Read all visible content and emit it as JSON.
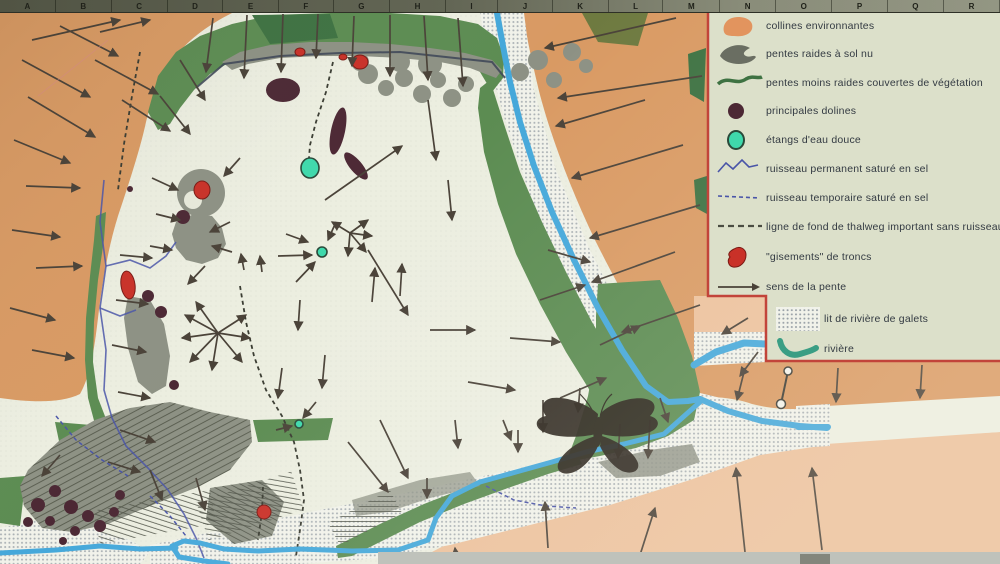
{
  "palette": {
    "hill_orange": "#d99a63",
    "salmon": "#ecc19c",
    "floor_cream": "#eceee0",
    "legend_bg": "#dce0ca",
    "veg_green": "#5c8c52",
    "dark_green": "#3e7242",
    "bare_gray": "#8d9184",
    "hatch_gray": "#565a4c",
    "river_blue": "#45a8da",
    "salt_blue": "#4a55a8",
    "pond_teal": "#3fd9ac",
    "doline_maroon": "#4c2834",
    "tronc_red": "#c93128",
    "arrow": "#4a4238",
    "legend_border": "#c2443a",
    "ruler_bg": "#6b6e5c",
    "text": "#333a42"
  },
  "ruler": {
    "letters": [
      "A",
      "B",
      "C",
      "D",
      "E",
      "F",
      "G",
      "H",
      "I",
      "J",
      "K",
      "L",
      "M",
      "N",
      "O",
      "P",
      "Q",
      "R"
    ]
  },
  "legend": {
    "items": [
      {
        "symbol": "hills",
        "label": "collines environnantes",
        "y": 3,
        "indent": 8
      },
      {
        "symbol": "steep",
        "label": "pentes raides à sol nu",
        "y": 31,
        "indent": 8
      },
      {
        "symbol": "gentle",
        "label": "pentes moins raides couvertes de végétation",
        "y": 60,
        "indent": 8
      },
      {
        "symbol": "doline",
        "label": "principales dolines",
        "y": 88,
        "indent": 8
      },
      {
        "symbol": "pond",
        "label": "étangs d'eau douce",
        "y": 117,
        "indent": 8
      },
      {
        "symbol": "perm",
        "label": "ruisseau permanent saturé en sel",
        "y": 146,
        "indent": 8
      },
      {
        "symbol": "temp",
        "label": "ruisseau temporaire saturé en sel",
        "y": 175,
        "indent": 8
      },
      {
        "symbol": "thalweg",
        "label": "ligne de fond de thalweg important sans ruisseau",
        "y": 204,
        "indent": 8
      },
      {
        "symbol": "troncs",
        "label": "\"gisements\" de troncs",
        "y": 234,
        "indent": 8
      },
      {
        "symbol": "slope",
        "label": "sens de la pente",
        "y": 264,
        "indent": 8
      },
      {
        "symbol": "gravel",
        "label": "lit de rivière de galets",
        "y": 296,
        "indent": 66
      },
      {
        "symbol": "river",
        "label": "rivière",
        "y": 326,
        "indent": 66
      }
    ]
  },
  "map": {
    "arrows": [
      [
        32,
        40,
        120,
        20
      ],
      [
        100,
        32,
        150,
        20
      ],
      [
        22,
        60,
        90,
        97
      ],
      [
        28,
        97,
        95,
        137
      ],
      [
        14,
        140,
        70,
        163
      ],
      [
        26,
        186,
        80,
        188
      ],
      [
        12,
        230,
        60,
        237
      ],
      [
        36,
        268,
        82,
        266
      ],
      [
        10,
        308,
        55,
        320
      ],
      [
        32,
        350,
        74,
        358
      ],
      [
        95,
        60,
        158,
        94
      ],
      [
        122,
        100,
        170,
        131
      ],
      [
        60,
        26,
        118,
        56
      ],
      [
        213,
        18,
        206,
        72
      ],
      [
        247,
        15,
        244,
        78
      ],
      [
        283,
        14,
        281,
        72
      ],
      [
        318,
        14,
        316,
        58
      ],
      [
        354,
        16,
        352,
        66
      ],
      [
        390,
        15,
        390,
        76
      ],
      [
        424,
        16,
        428,
        80
      ],
      [
        458,
        18,
        463,
        86
      ],
      [
        180,
        60,
        205,
        100
      ],
      [
        160,
        96,
        190,
        134
      ],
      [
        676,
        18,
        545,
        48
      ],
      [
        702,
        76,
        558,
        98
      ],
      [
        645,
        100,
        556,
        126
      ],
      [
        683,
        145,
        572,
        178
      ],
      [
        700,
        205,
        590,
        238
      ],
      [
        675,
        252,
        592,
        282
      ],
      [
        700,
        305,
        622,
        332
      ],
      [
        748,
        318,
        722,
        334
      ],
      [
        758,
        352,
        740,
        376
      ],
      [
        152,
        178,
        178,
        190
      ],
      [
        156,
        214,
        180,
        220
      ],
      [
        240,
        158,
        224,
        176
      ],
      [
        150,
        246,
        172,
        250
      ],
      [
        230,
        222,
        210,
        232
      ],
      [
        232,
        252,
        212,
        246
      ],
      [
        205,
        266,
        188,
        284
      ],
      [
        120,
        255,
        152,
        258
      ],
      [
        116,
        300,
        148,
        304
      ],
      [
        112,
        345,
        146,
        352
      ],
      [
        118,
        392,
        150,
        398
      ],
      [
        218,
        333,
        185,
        315
      ],
      [
        218,
        333,
        182,
        338
      ],
      [
        218,
        333,
        190,
        362
      ],
      [
        218,
        333,
        212,
        370
      ],
      [
        218,
        333,
        242,
        362
      ],
      [
        218,
        333,
        250,
        338
      ],
      [
        218,
        333,
        246,
        315
      ],
      [
        218,
        333,
        196,
        302
      ],
      [
        350,
        233,
        368,
        220
      ],
      [
        350,
        233,
        372,
        236
      ],
      [
        350,
        233,
        366,
        252
      ],
      [
        350,
        233,
        348,
        256
      ],
      [
        350,
        233,
        332,
        222
      ],
      [
        286,
        234,
        308,
        242
      ],
      [
        278,
        256,
        312,
        255
      ],
      [
        296,
        282,
        315,
        262
      ],
      [
        336,
        222,
        328,
        240
      ],
      [
        244,
        270,
        241,
        254
      ],
      [
        262,
        272,
        260,
        256
      ],
      [
        325,
        200,
        402,
        146
      ],
      [
        368,
        250,
        408,
        315
      ],
      [
        372,
        302,
        375,
        268
      ],
      [
        400,
        296,
        402,
        264
      ],
      [
        300,
        300,
        298,
        330
      ],
      [
        325,
        355,
        322,
        388
      ],
      [
        282,
        368,
        278,
        398
      ],
      [
        316,
        402,
        303,
        418
      ],
      [
        276,
        430,
        292,
        426
      ],
      [
        428,
        100,
        436,
        160
      ],
      [
        448,
        180,
        452,
        220
      ],
      [
        430,
        330,
        475,
        330
      ],
      [
        510,
        338,
        560,
        342
      ],
      [
        468,
        382,
        515,
        390
      ],
      [
        540,
        300,
        585,
        285
      ],
      [
        560,
        398,
        606,
        378
      ],
      [
        600,
        345,
        640,
        326
      ],
      [
        548,
        250,
        590,
        262
      ],
      [
        348,
        442,
        388,
        492
      ],
      [
        380,
        420,
        408,
        478
      ],
      [
        455,
        420,
        458,
        448
      ],
      [
        503,
        420,
        511,
        440
      ],
      [
        518,
        430,
        518,
        452
      ],
      [
        427,
        478,
        427,
        498
      ],
      [
        543,
        400,
        543,
        432
      ],
      [
        620,
        424,
        618,
        458
      ],
      [
        650,
        420,
        648,
        458
      ],
      [
        580,
        388,
        578,
        412
      ],
      [
        660,
        398,
        668,
        422
      ],
      [
        548,
        548,
        545,
        502
      ],
      [
        457,
        564,
        455,
        548
      ],
      [
        640,
        555,
        655,
        508
      ],
      [
        745,
        552,
        736,
        468
      ],
      [
        822,
        550,
        812,
        468
      ],
      [
        745,
        368,
        737,
        400
      ],
      [
        838,
        368,
        836,
        402
      ],
      [
        922,
        365,
        920,
        398
      ],
      [
        120,
        430,
        155,
        442
      ],
      [
        108,
        462,
        140,
        472
      ],
      [
        150,
        470,
        162,
        500
      ],
      [
        196,
        478,
        205,
        510
      ],
      [
        60,
        455,
        42,
        476
      ]
    ],
    "dolines": [
      [
        283,
        90,
        17,
        12,
        0
      ],
      [
        338,
        131,
        7,
        24,
        12
      ],
      [
        356,
        166,
        6,
        17,
        -40
      ],
      [
        183,
        217,
        7,
        7,
        0
      ],
      [
        148,
        296,
        6,
        6,
        0
      ],
      [
        161,
        312,
        6,
        6,
        0
      ],
      [
        174,
        385,
        5,
        5,
        0
      ],
      [
        130,
        189,
        3,
        3,
        0
      ],
      [
        38,
        505,
        7,
        7,
        0
      ],
      [
        55,
        491,
        6,
        6,
        0
      ],
      [
        71,
        507,
        7,
        7,
        0
      ],
      [
        88,
        516,
        6,
        6,
        0
      ],
      [
        50,
        521,
        5,
        5,
        0
      ],
      [
        75,
        531,
        5,
        5,
        0
      ],
      [
        100,
        526,
        6,
        6,
        0
      ],
      [
        114,
        512,
        5,
        5,
        0
      ],
      [
        28,
        522,
        5,
        5,
        0
      ],
      [
        63,
        541,
        4,
        4,
        0
      ],
      [
        120,
        495,
        5,
        5,
        0
      ]
    ],
    "ponds": [
      [
        310,
        168,
        9,
        10
      ],
      [
        322,
        252,
        5,
        5
      ],
      [
        299,
        424,
        4,
        4
      ]
    ],
    "troncs": [
      [
        360,
        62,
        8,
        7,
        0
      ],
      [
        300,
        52,
        5,
        4,
        0
      ],
      [
        343,
        57,
        4,
        3,
        0
      ],
      [
        202,
        190,
        8,
        9,
        0
      ],
      [
        128,
        285,
        7,
        14,
        -8
      ],
      [
        264,
        512,
        7,
        7,
        0
      ]
    ],
    "salt_streams": [
      [
        [
          104,
          180
        ],
        [
          100,
          222
        ],
        [
          106,
          266
        ],
        [
          100,
          308
        ],
        [
          106,
          350
        ],
        [
          104,
          390
        ],
        [
          112,
          418
        ],
        [
          126,
          446
        ],
        [
          148,
          468
        ],
        [
          168,
          490
        ],
        [
          184,
          514
        ],
        [
          196,
          538
        ],
        [
          204,
          558
        ]
      ],
      [
        [
          106,
          266
        ],
        [
          130,
          260
        ],
        [
          150,
          268
        ],
        [
          166,
          256
        ],
        [
          176,
          242
        ]
      ],
      [
        [
          100,
          308
        ],
        [
          120,
          316
        ],
        [
          136,
          310
        ]
      ]
    ],
    "crest_line": [
      [
        196,
        88
      ],
      [
        224,
        64
      ],
      [
        280,
        56
      ],
      [
        340,
        53
      ],
      [
        400,
        52
      ],
      [
        455,
        58
      ],
      [
        492,
        62
      ],
      [
        505,
        78
      ]
    ],
    "dashed_dark": [
      [
        [
          333,
          62
        ],
        [
          326,
          92
        ],
        [
          316,
          122
        ],
        [
          310,
          145
        ],
        [
          309,
          158
        ]
      ],
      [
        [
          240,
          286
        ],
        [
          246,
          322
        ],
        [
          254,
          356
        ],
        [
          266,
          390
        ],
        [
          282,
          416
        ],
        [
          294,
          442
        ],
        [
          300,
          470
        ],
        [
          304,
          500
        ],
        [
          300,
          530
        ],
        [
          296,
          556
        ]
      ],
      [
        [
          263,
          487
        ],
        [
          262,
          512
        ],
        [
          258,
          540
        ]
      ],
      [
        [
          140,
          52
        ],
        [
          132,
          96
        ],
        [
          124,
          144
        ],
        [
          118,
          190
        ]
      ]
    ],
    "dashed_blue": [
      [
        [
          56,
          416
        ],
        [
          76,
          440
        ],
        [
          102,
          460
        ],
        [
          128,
          476
        ]
      ],
      [
        [
          486,
          486
        ],
        [
          514,
          500
        ],
        [
          546,
          506
        ],
        [
          576,
          508
        ]
      ],
      [
        [
          150,
          496
        ],
        [
          170,
          516
        ],
        [
          186,
          536
        ]
      ]
    ],
    "rivers": [
      {
        "w": 6,
        "pts": [
          [
            497,
            13
          ],
          [
            503,
            46
          ],
          [
            510,
            82
          ],
          [
            520,
            122
          ],
          [
            534,
            166
          ],
          [
            552,
            212
          ],
          [
            574,
            260
          ],
          [
            598,
            308
          ],
          [
            622,
            350
          ],
          [
            646,
            386
          ],
          [
            668,
            402
          ],
          [
            688,
            401
          ],
          [
            700,
            399
          ]
        ]
      },
      {
        "w": 6,
        "pts": [
          [
            700,
            399
          ],
          [
            728,
            411
          ],
          [
            762,
            421
          ],
          [
            800,
            426
          ],
          [
            827,
            428
          ]
        ]
      },
      {
        "w": 5,
        "pts": [
          [
            700,
            402
          ],
          [
            664,
            434
          ],
          [
            624,
            444
          ],
          [
            586,
            452
          ],
          [
            552,
            462
          ],
          [
            516,
            472
          ],
          [
            480,
            482
          ],
          [
            452,
            496
          ],
          [
            436,
            518
          ],
          [
            428,
            540
          ],
          [
            398,
            550
          ],
          [
            352,
            551
          ],
          [
            300,
            549
          ],
          [
            258,
            551
          ],
          [
            224,
            549
          ],
          [
            200,
            543
          ],
          [
            184,
            541
          ],
          [
            172,
            546
          ],
          [
            179,
            557
          ],
          [
            204,
            561
          ],
          [
            228,
            564
          ]
        ]
      },
      {
        "w": 5,
        "pts": [
          [
            176,
            548
          ],
          [
            140,
            549
          ],
          [
            100,
            546
          ],
          [
            56,
            550
          ],
          [
            0,
            553
          ]
        ]
      },
      {
        "w": 7,
        "pts": [
          [
            694,
            365
          ],
          [
            716,
            352
          ],
          [
            744,
            343
          ],
          [
            766,
            344
          ]
        ]
      },
      {
        "w": 6,
        "pts": [
          [
            798,
            427
          ],
          [
            828,
            427
          ]
        ]
      }
    ],
    "marker_line": {
      "x1": 788,
      "y1": 371,
      "x2": 781,
      "y2": 404
    }
  }
}
